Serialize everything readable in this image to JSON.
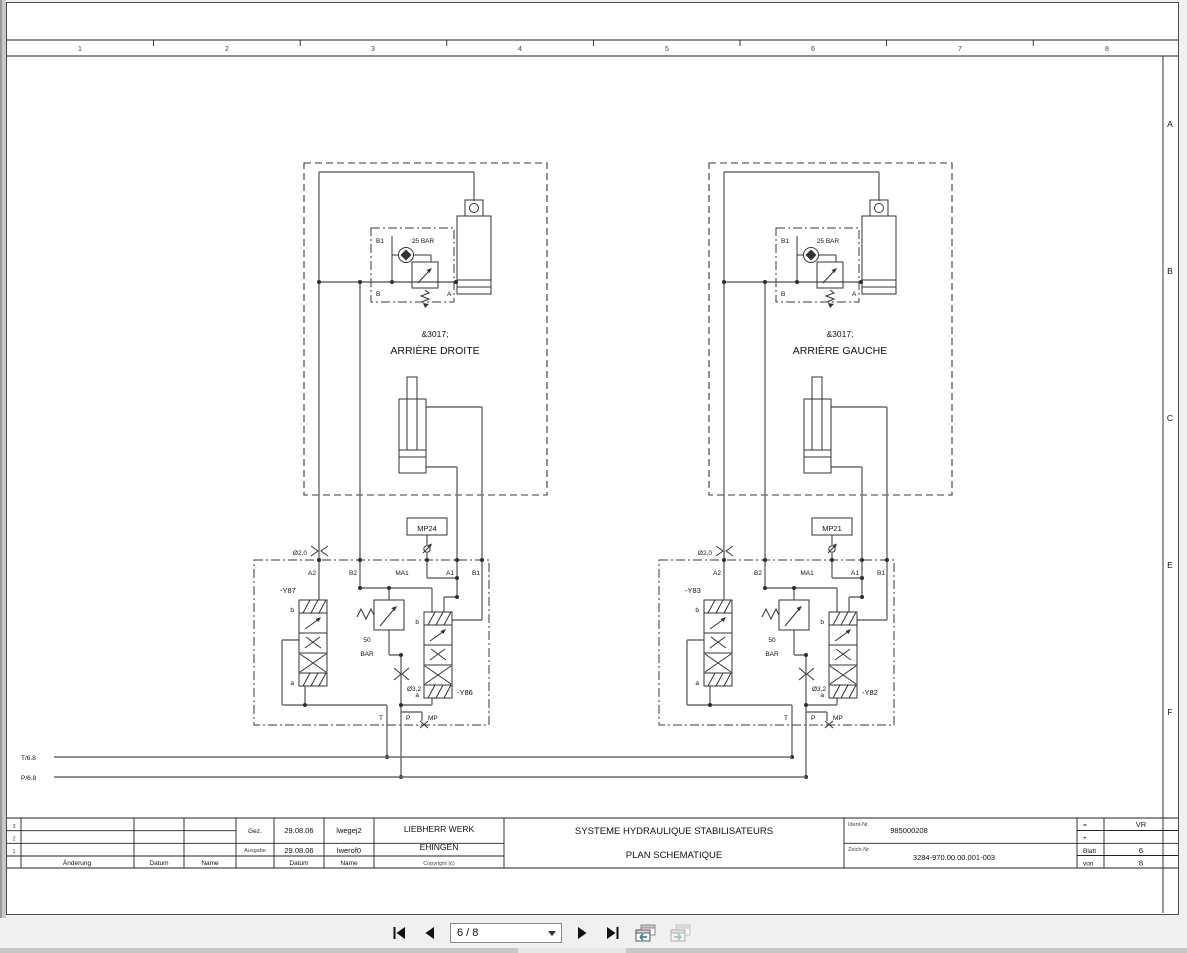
{
  "frame": {
    "columns": [
      "1",
      "2",
      "3",
      "4",
      "5",
      "6",
      "7",
      "8"
    ],
    "rows": [
      "A",
      "B",
      "C",
      "E",
      "F"
    ]
  },
  "refs": {
    "t": "T/6.8",
    "p": "P/6.8"
  },
  "stations": [
    {
      "code": "&3017;",
      "name": "ARRIÈRE DROITE",
      "pressure_top": "25 BAR",
      "cyl_port": "B1",
      "port_b": "B",
      "port_a": "A",
      "mp_box": "MP24",
      "orifice_top": "Ø2,0",
      "ports_top": [
        "A2",
        "B2",
        "MA1",
        "A1",
        "B1"
      ],
      "valve_left": "-Y87",
      "valve_right": "-Y86",
      "b": "b",
      "a": "a",
      "relief_value": "50",
      "relief_unit": "BAR",
      "orifice_bottom": "Ø3,2",
      "port_t": "T",
      "port_p": "P",
      "port_mp": "MP"
    },
    {
      "code": "&3017;",
      "name": "ARRIÈRE GAUCHE",
      "pressure_top": "25 BAR",
      "cyl_port": "B1",
      "port_b": "B",
      "port_a": "A",
      "mp_box": "MP21",
      "orifice_top": "Ø2,0",
      "ports_top": [
        "A2",
        "B2",
        "MA1",
        "A1",
        "B1"
      ],
      "valve_left": "-Y83",
      "valve_right": "-Y82",
      "b": "b",
      "a": "a",
      "relief_value": "50",
      "relief_unit": "BAR",
      "orifice_bottom": "Ø3,2",
      "port_t": "T",
      "port_p": "P",
      "port_mp": "MP"
    }
  ],
  "title_block": {
    "revision": {
      "rows": [
        "3",
        "2",
        "1"
      ],
      "col_aenderung": "Änderung",
      "col_datum": "Datum",
      "col_name": "Name"
    },
    "signature": {
      "gez_label": "Gez.",
      "gez_date": "29.08.06",
      "gez_name": "lwegej2",
      "ausgabe_label": "Ausgabe",
      "ausgabe_date": "29.08.06",
      "ausgabe_name": "lwerof0",
      "col_datum": "Datum",
      "col_name": "Name"
    },
    "company": {
      "line1": "LIEBHERR WERK",
      "line2": "EHINGEN",
      "copyright": "Copyright (c)"
    },
    "drawing_title": {
      "line1": "SYSTEME HYDRAULIQUE STABILISATEURS",
      "line2": "PLAN SCHEMATIQUE"
    },
    "ident": {
      "label": "Ident-Nr.",
      "value": "985000208"
    },
    "zeich": {
      "label": "Zeich-Nr.",
      "value": "3284-970.00.00.001-003"
    },
    "right": {
      "eq_label": "=",
      "eq_value": "VR",
      "plus_label": "+",
      "blatt_label": "Blatt",
      "blatt_value": "6",
      "von_label": "von",
      "von_value": "8"
    }
  },
  "nav": {
    "page": "6 / 8"
  }
}
